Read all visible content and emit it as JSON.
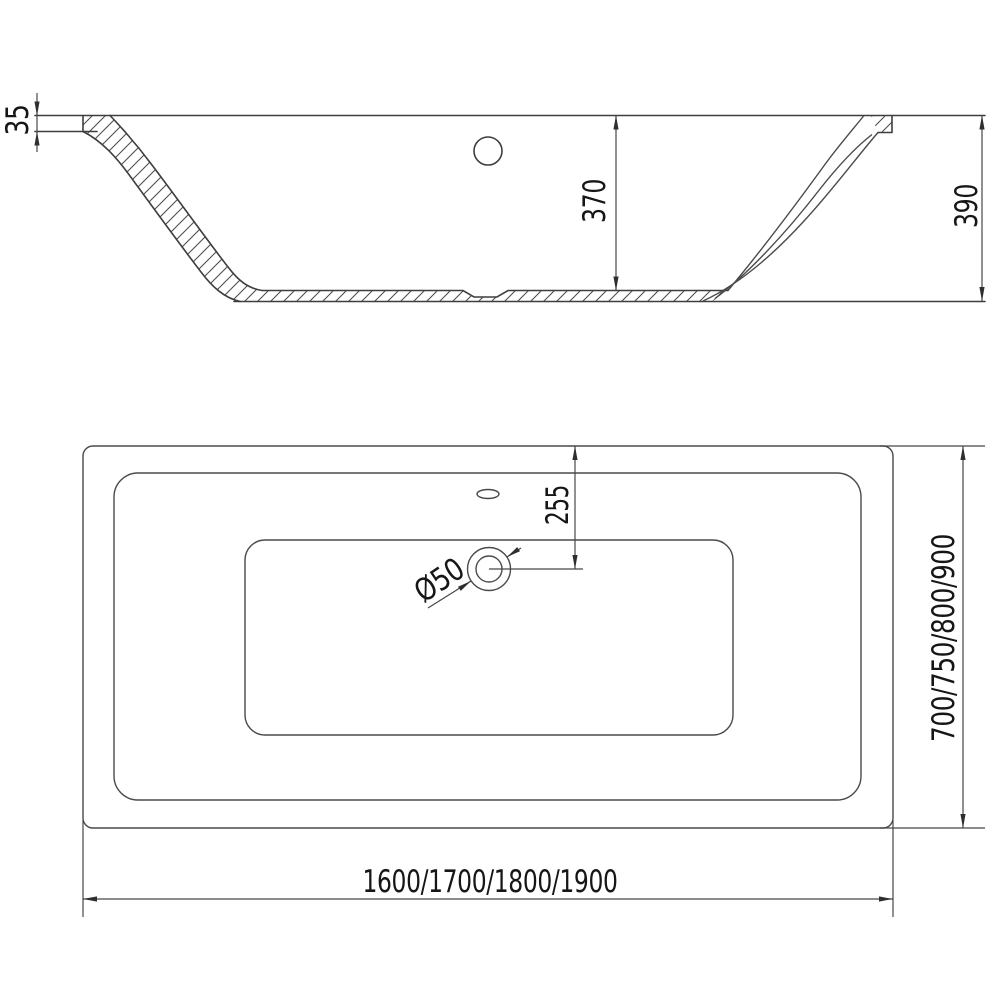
{
  "document": {
    "kind": "bathtub-technical-drawing",
    "background_color": "#ffffff",
    "line_color": "#3e3e3e",
    "dimension_line_color": "#474747",
    "text_color": "#161616"
  },
  "section_view": {
    "description": "longitudinal cross-section of rectangular bathtub",
    "rim_thickness_label": "35",
    "inner_depth_label": "370",
    "overall_height_label": "390"
  },
  "plan_view": {
    "description": "top view of rectangular bathtub",
    "drain_offset_label": "255",
    "drain_diameter_label": "Ø50",
    "width_options_label": "700/750/800/900",
    "length_options_label": "1600/1700/1800/1900"
  }
}
